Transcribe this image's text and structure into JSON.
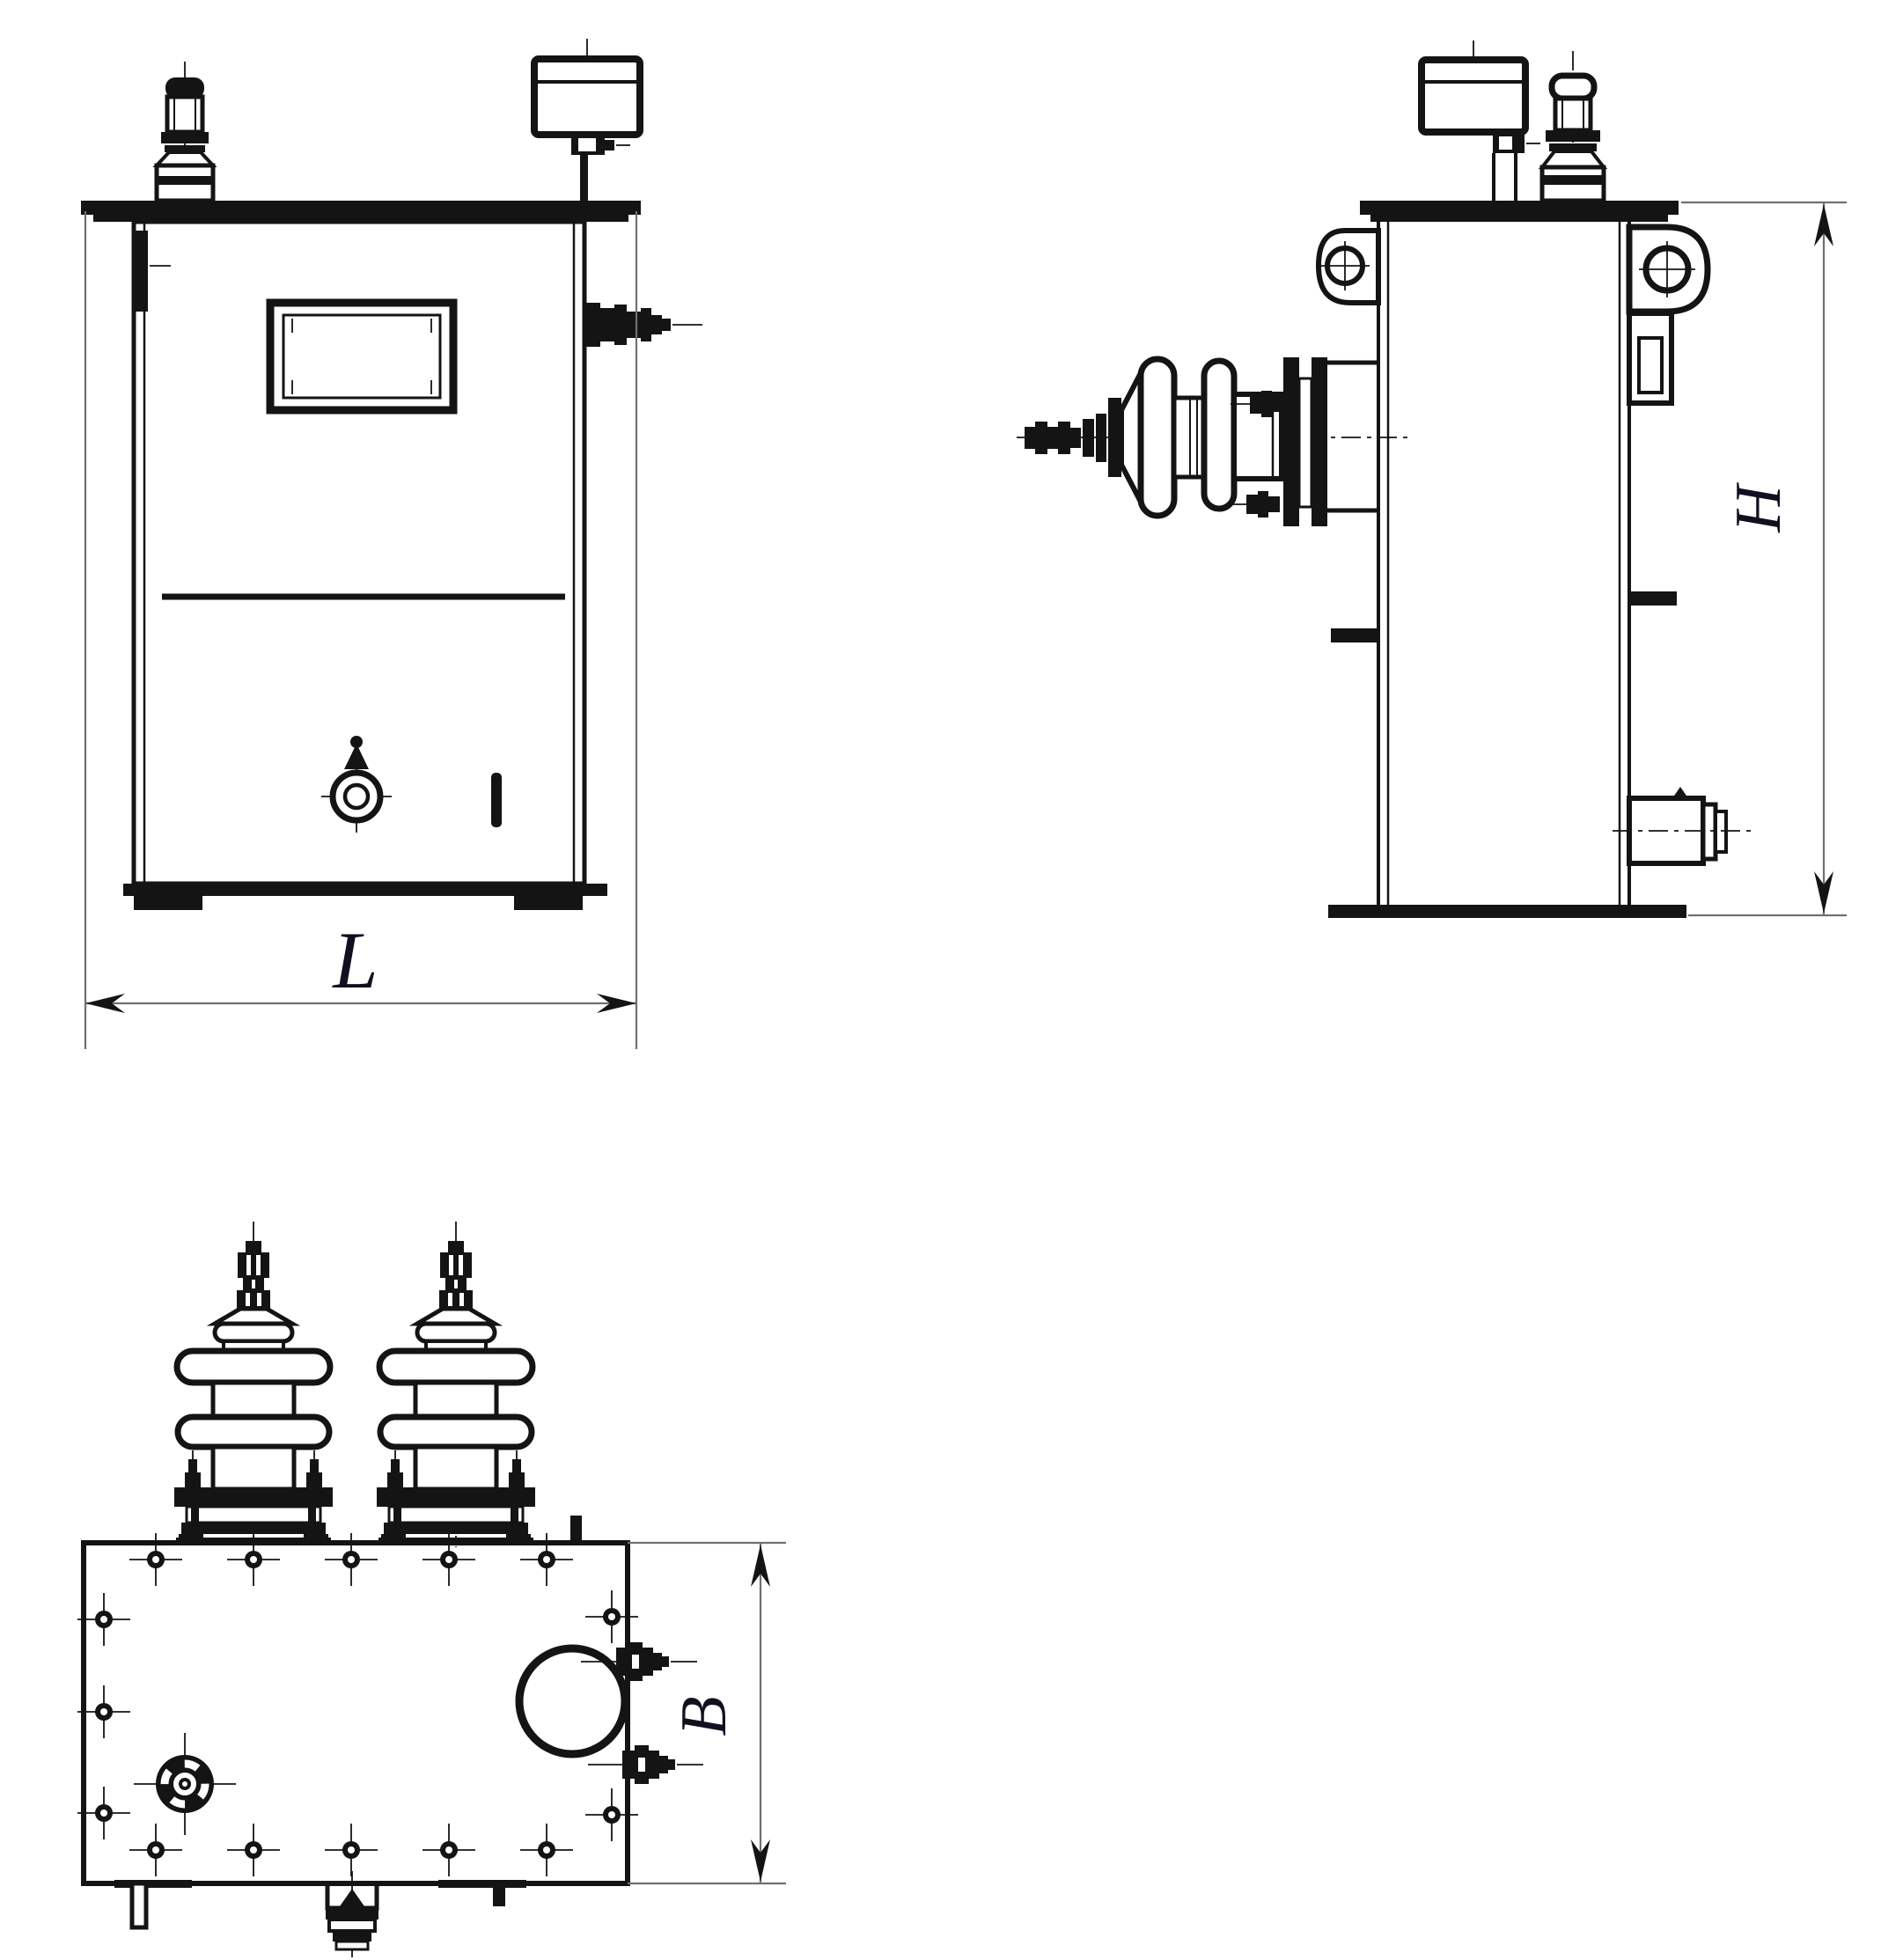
{
  "drawing": {
    "dimensions": {
      "length_label": "L",
      "height_label": "H",
      "width_label": "B"
    },
    "colors": {
      "ink": "#141414",
      "dim": "#707070",
      "label": "#101020",
      "background": "#ffffff"
    }
  }
}
